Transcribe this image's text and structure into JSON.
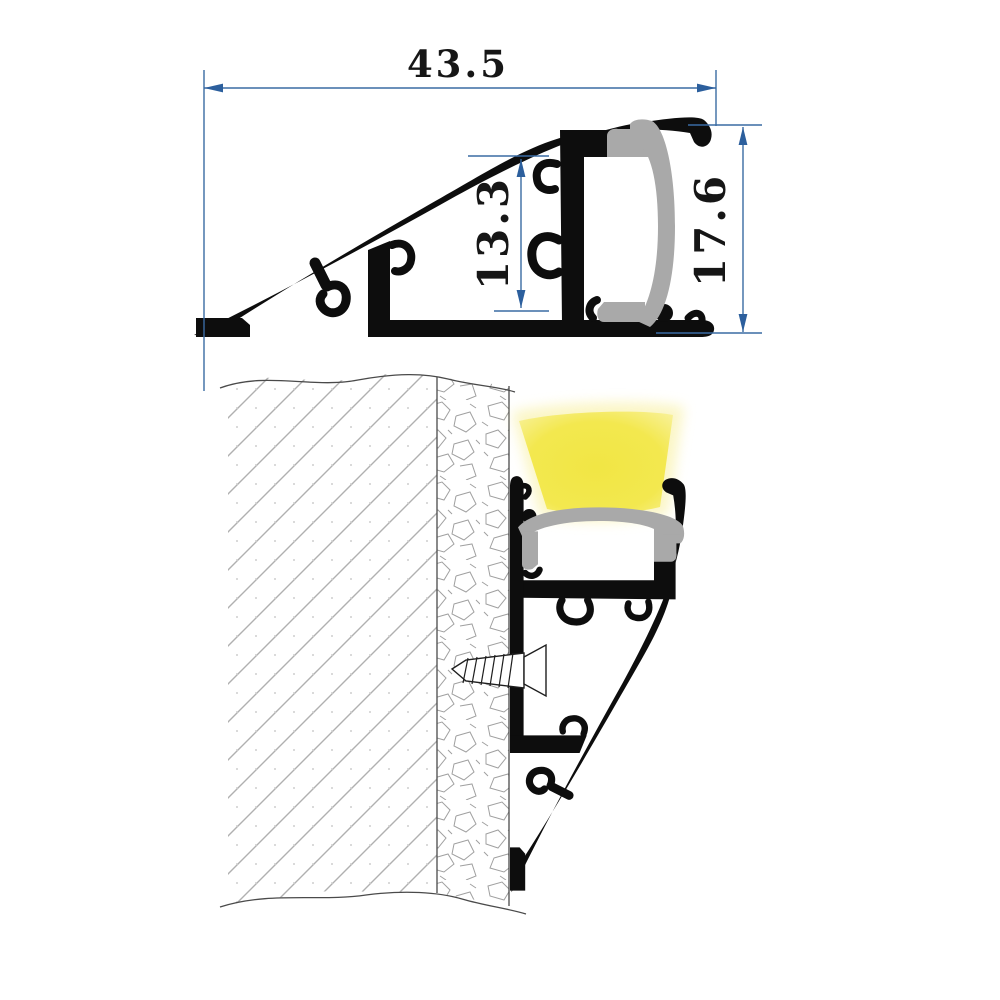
{
  "dimensions": {
    "width": "43.5",
    "inner_height": "13.3",
    "overall_height": "17.6"
  },
  "colors": {
    "dimension_blue": "#3a6ba3",
    "arrow_blue": "#2c5f9d",
    "profile_black": "#0d0d0d",
    "diffuser_gray": "#a9a9a9",
    "led_glow_yellow": "#f3e84f",
    "led_glow_halo": "#f8f0a0",
    "wall_hatch_gray": "#b0b0b0",
    "wall_edge_gray": "#4a4a4a",
    "plaster_crack_gray": "#a0a0a0",
    "background": "#ffffff"
  },
  "icons": {
    "screw": "screw-icon",
    "led_glow": "led-glow",
    "diffuser": "diffuser-cover"
  }
}
